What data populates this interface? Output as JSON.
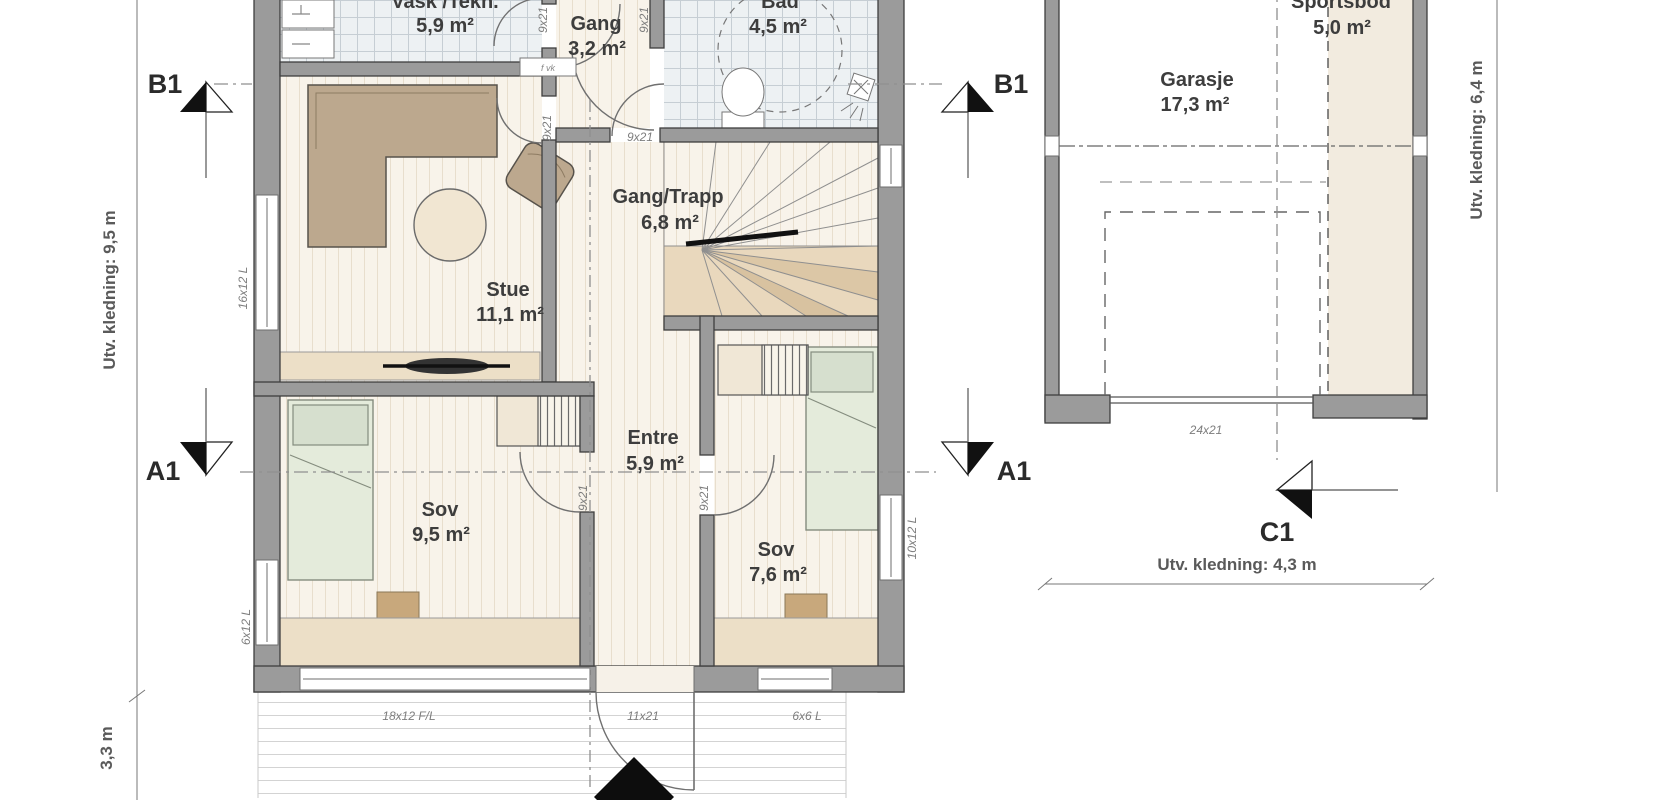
{
  "drawing_type": "architectural-floor-plan",
  "colors": {
    "wall_fill": "#9b9b9b",
    "wall_outline": "#3f3f3f",
    "wood_floor": "#f8f3ea",
    "tile_floor": "#eef1f3",
    "furniture_tan": "#bca88e",
    "bed_green": "#e4ebdb",
    "bench_beige": "#ecdfc7",
    "stair_beige": "#e9d8bd",
    "sportsbod_fill": "#f2ebdf"
  },
  "house": {
    "rooms": {
      "vask": {
        "name": "Vask /Tekn.",
        "area": "5,9 m²"
      },
      "gang": {
        "name": "Gang",
        "area": "3,2 m²"
      },
      "bad": {
        "name": "Bad",
        "area": "4,5 m²"
      },
      "gang_trapp": {
        "name": "Gang/Trapp",
        "area": "6,8 m²"
      },
      "stue": {
        "name": "Stue",
        "area": "11,1 m²"
      },
      "sov_1": {
        "name": "Sov",
        "area": "9,5 m²"
      },
      "entre": {
        "name": "Entre",
        "area": "5,9 m²"
      },
      "sov_2": {
        "name": "Sov",
        "area": "7,6 m²"
      }
    },
    "openings": {
      "w_16x12": "16x12 L",
      "w_6x12": "6x12 L",
      "w_18x12": "18x12 F/L",
      "d_11x21": "11x21",
      "w_6x6": "6x6 L",
      "w_10x12": "10x12 L",
      "d_9x21": "9x21",
      "tech_box": "f vk"
    }
  },
  "garage": {
    "rooms": {
      "garasje": {
        "name": "Garasje",
        "area": "17,3 m²"
      },
      "sportsbod": {
        "name": "Sportsbod",
        "area": "5,0 m²"
      }
    },
    "openings": {
      "door_24x21": "24x21"
    }
  },
  "dimensions": {
    "left": "Utv. kledning: 9,5 m",
    "terrace": "3,3 m",
    "right": "Utv. kledning: 6,4 m",
    "garage_front": "Utv. kledning: 4,3 m"
  },
  "section_markers": {
    "b1": "B1",
    "a1": "A1",
    "c1": "C1"
  }
}
